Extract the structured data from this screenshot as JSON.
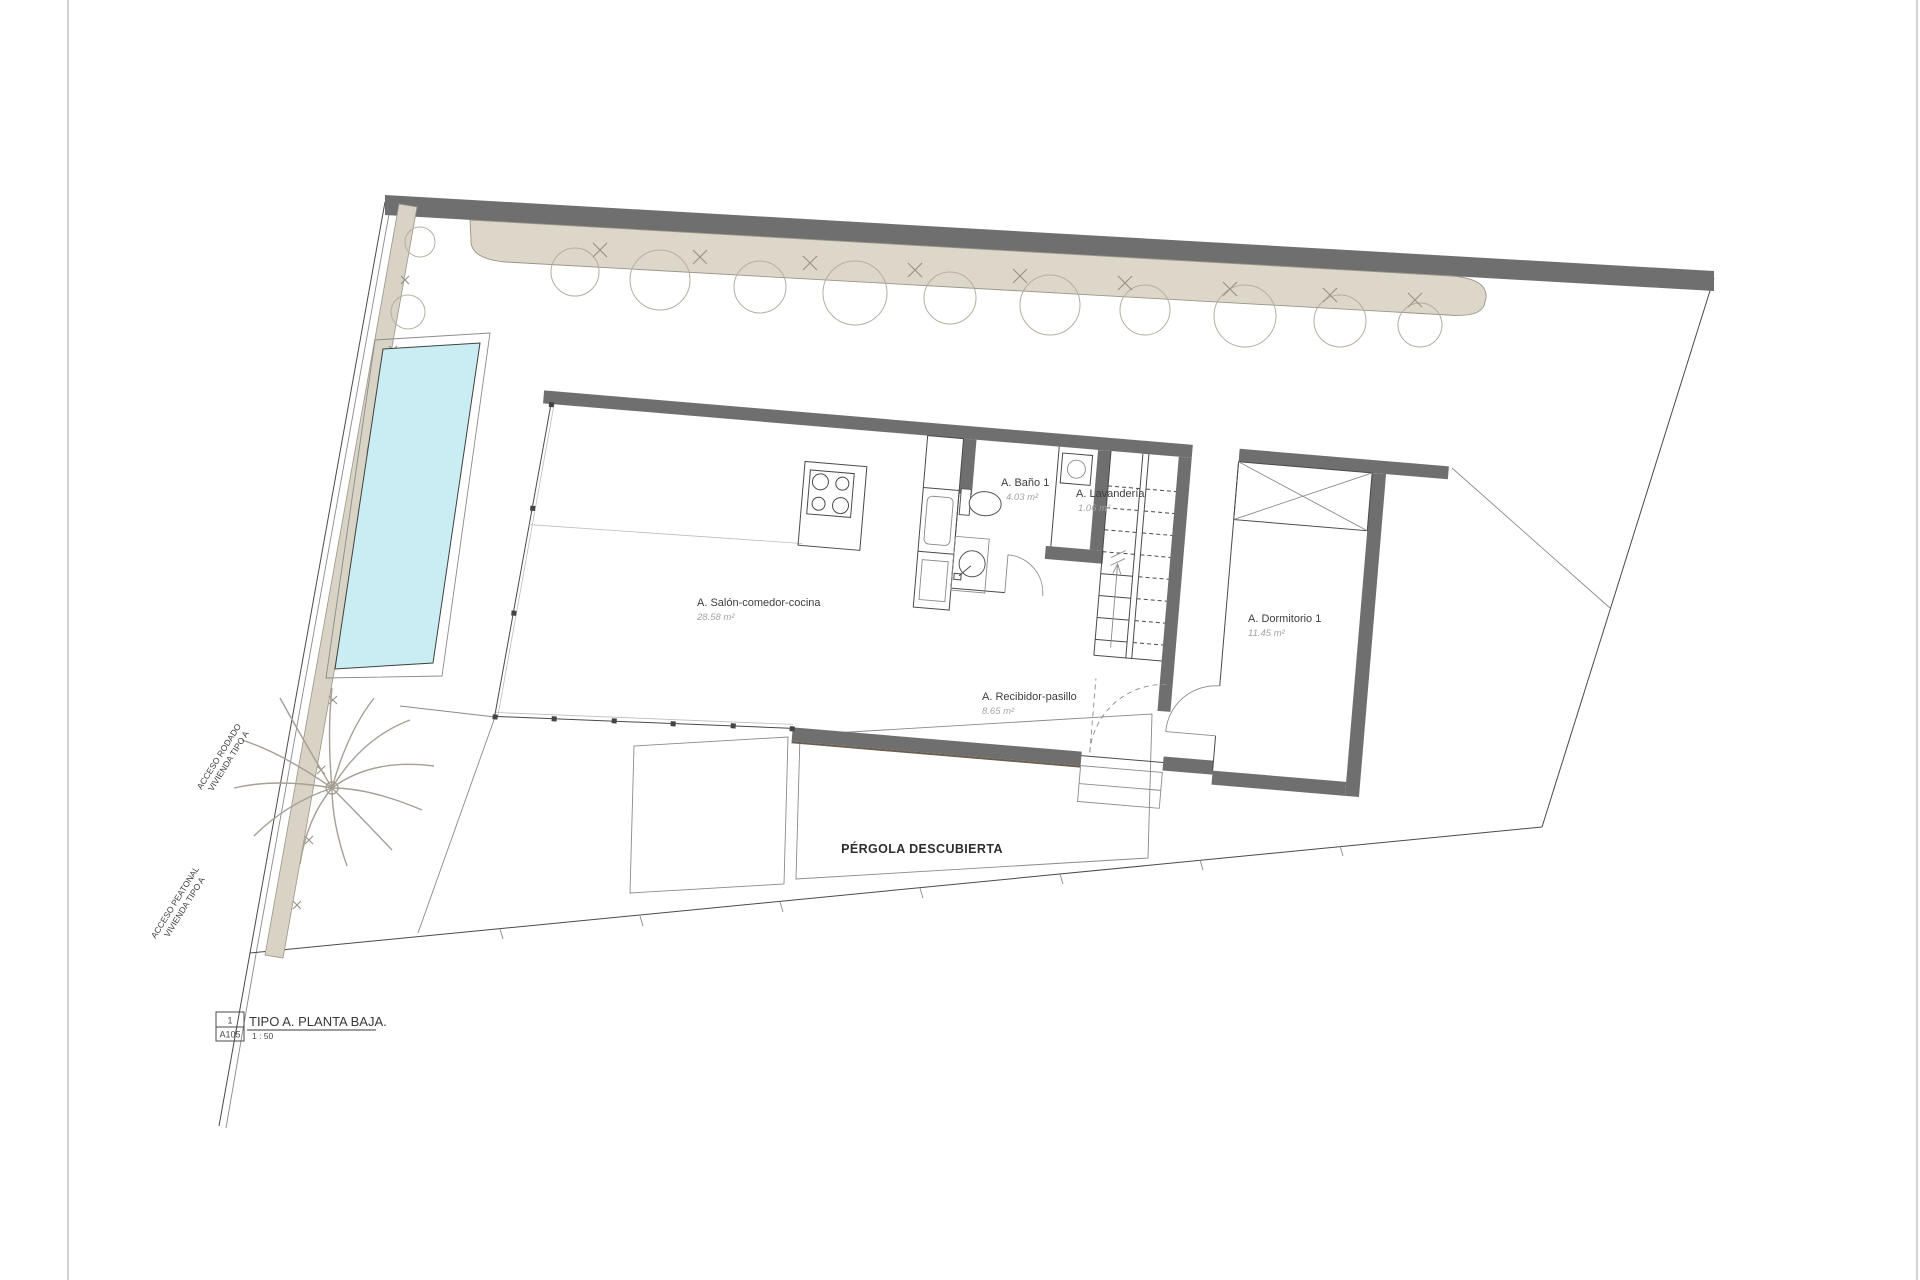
{
  "drawing": {
    "rooms": [
      {
        "name": "A. Salón-comedor-cocina",
        "area": "28.58 m²"
      },
      {
        "name": "A. Baño 1",
        "area": "4.03 m²"
      },
      {
        "name": "A. Lavandería",
        "area": "1.06 m²"
      },
      {
        "name": "A. Dormitorio 1",
        "area": "11.45 m²"
      },
      {
        "name": "A. Recibidor-pasillo",
        "area": "8.65 m²"
      }
    ],
    "outdoor": {
      "pergola": "PÉRGOLA DESCUBIERTA"
    },
    "access": [
      {
        "line1": "ACCESO RODADO",
        "line2": "VIVIENDA TIPO A"
      },
      {
        "line1": "ACCESO PEATONAL",
        "line2": "VIVIENDA TIPO A"
      }
    ],
    "title_block": {
      "detail_number": "1",
      "sheet": "A105",
      "title": "TIPO A. PLANTA BAJA.",
      "scale": "1 : 50"
    },
    "colors": {
      "wall": "#6f6f6f",
      "hedge": "#dcd7c9",
      "path": "#d8d3c4",
      "pool": "#c9edf3",
      "bush": "#b5afa0",
      "line": "#4a4a4a"
    }
  }
}
